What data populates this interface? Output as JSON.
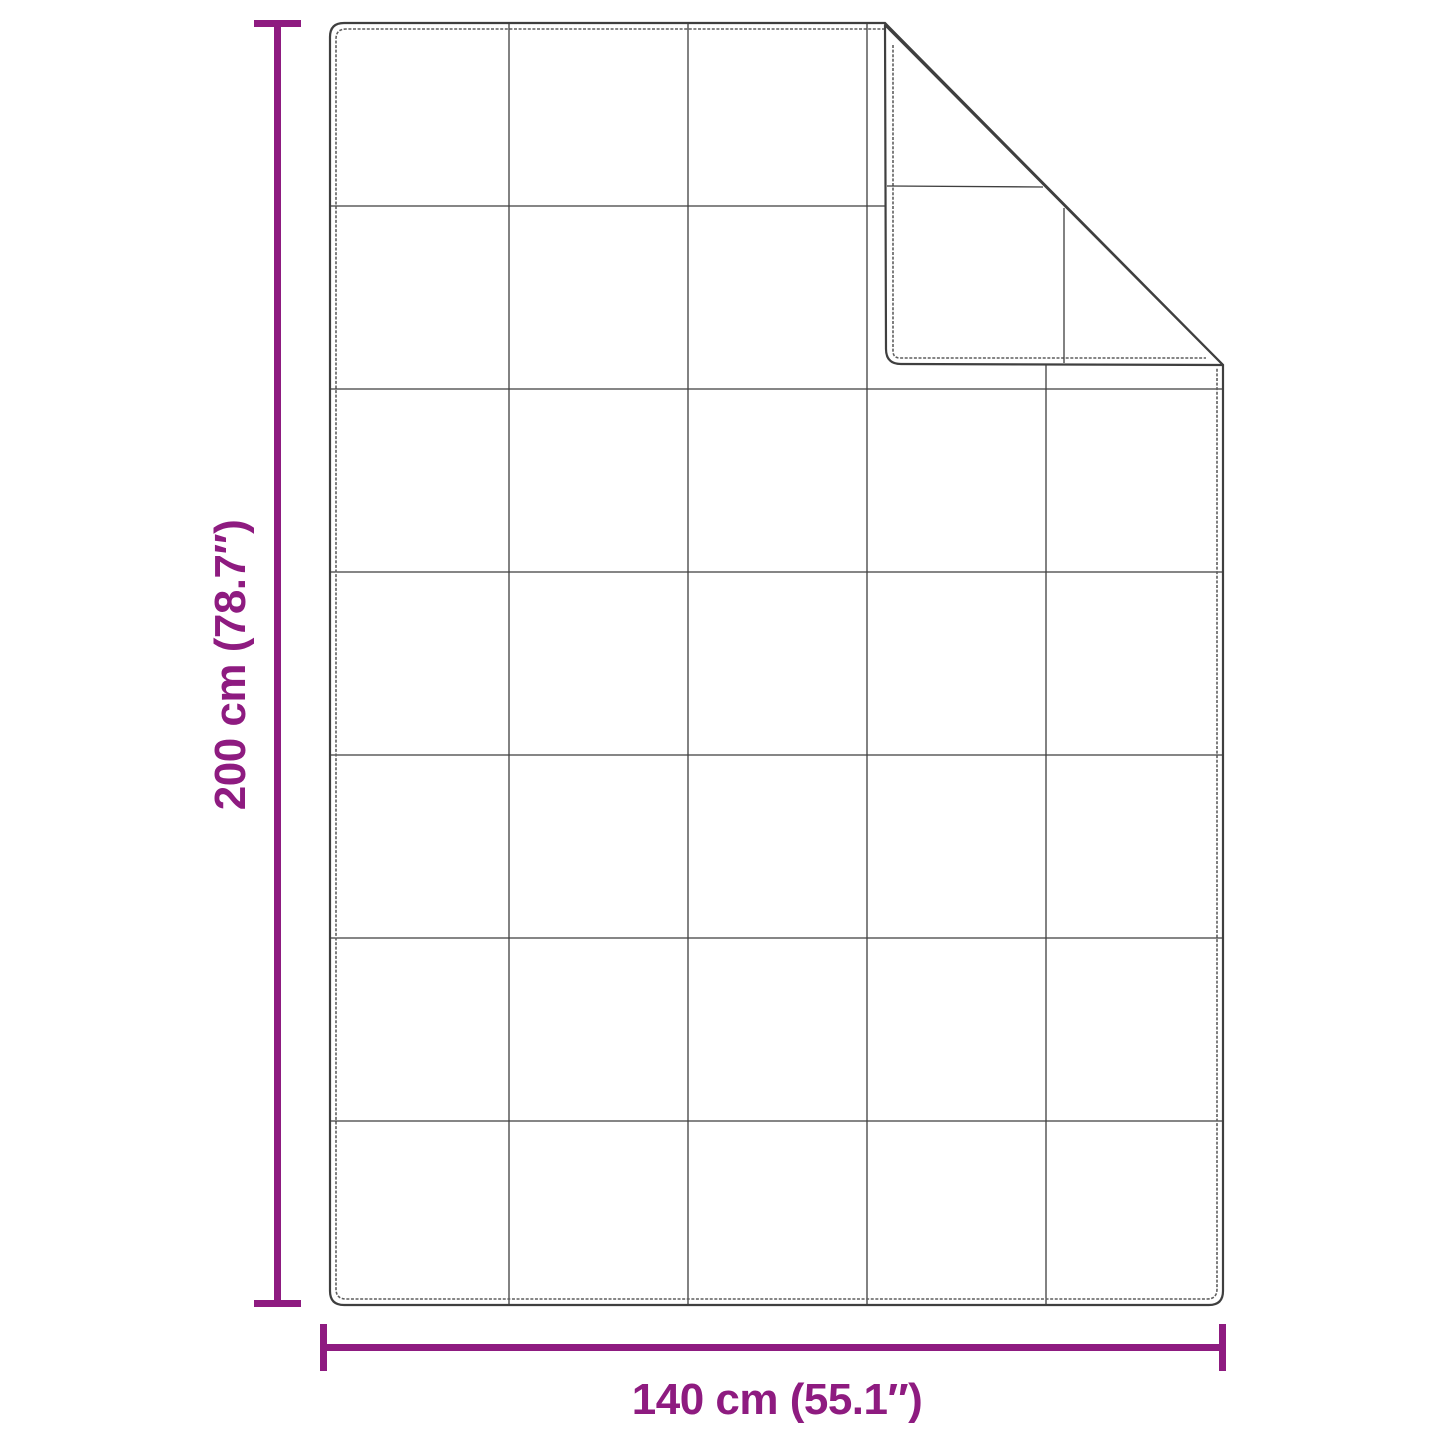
{
  "diagram": {
    "height_label": "200 cm (78.7″)",
    "width_label": "140 cm (55.1″)",
    "height_cm": "200",
    "height_inches": "78.7",
    "width_cm": "140",
    "width_inches": "55.1",
    "grid_columns": "5",
    "grid_rows": "7",
    "accent_color": "#8e1b80",
    "line_color": "#3f3f3f",
    "stitch_color": "#5f5f5f",
    "grid_line_color": "#454545",
    "background": "#ffffff"
  }
}
